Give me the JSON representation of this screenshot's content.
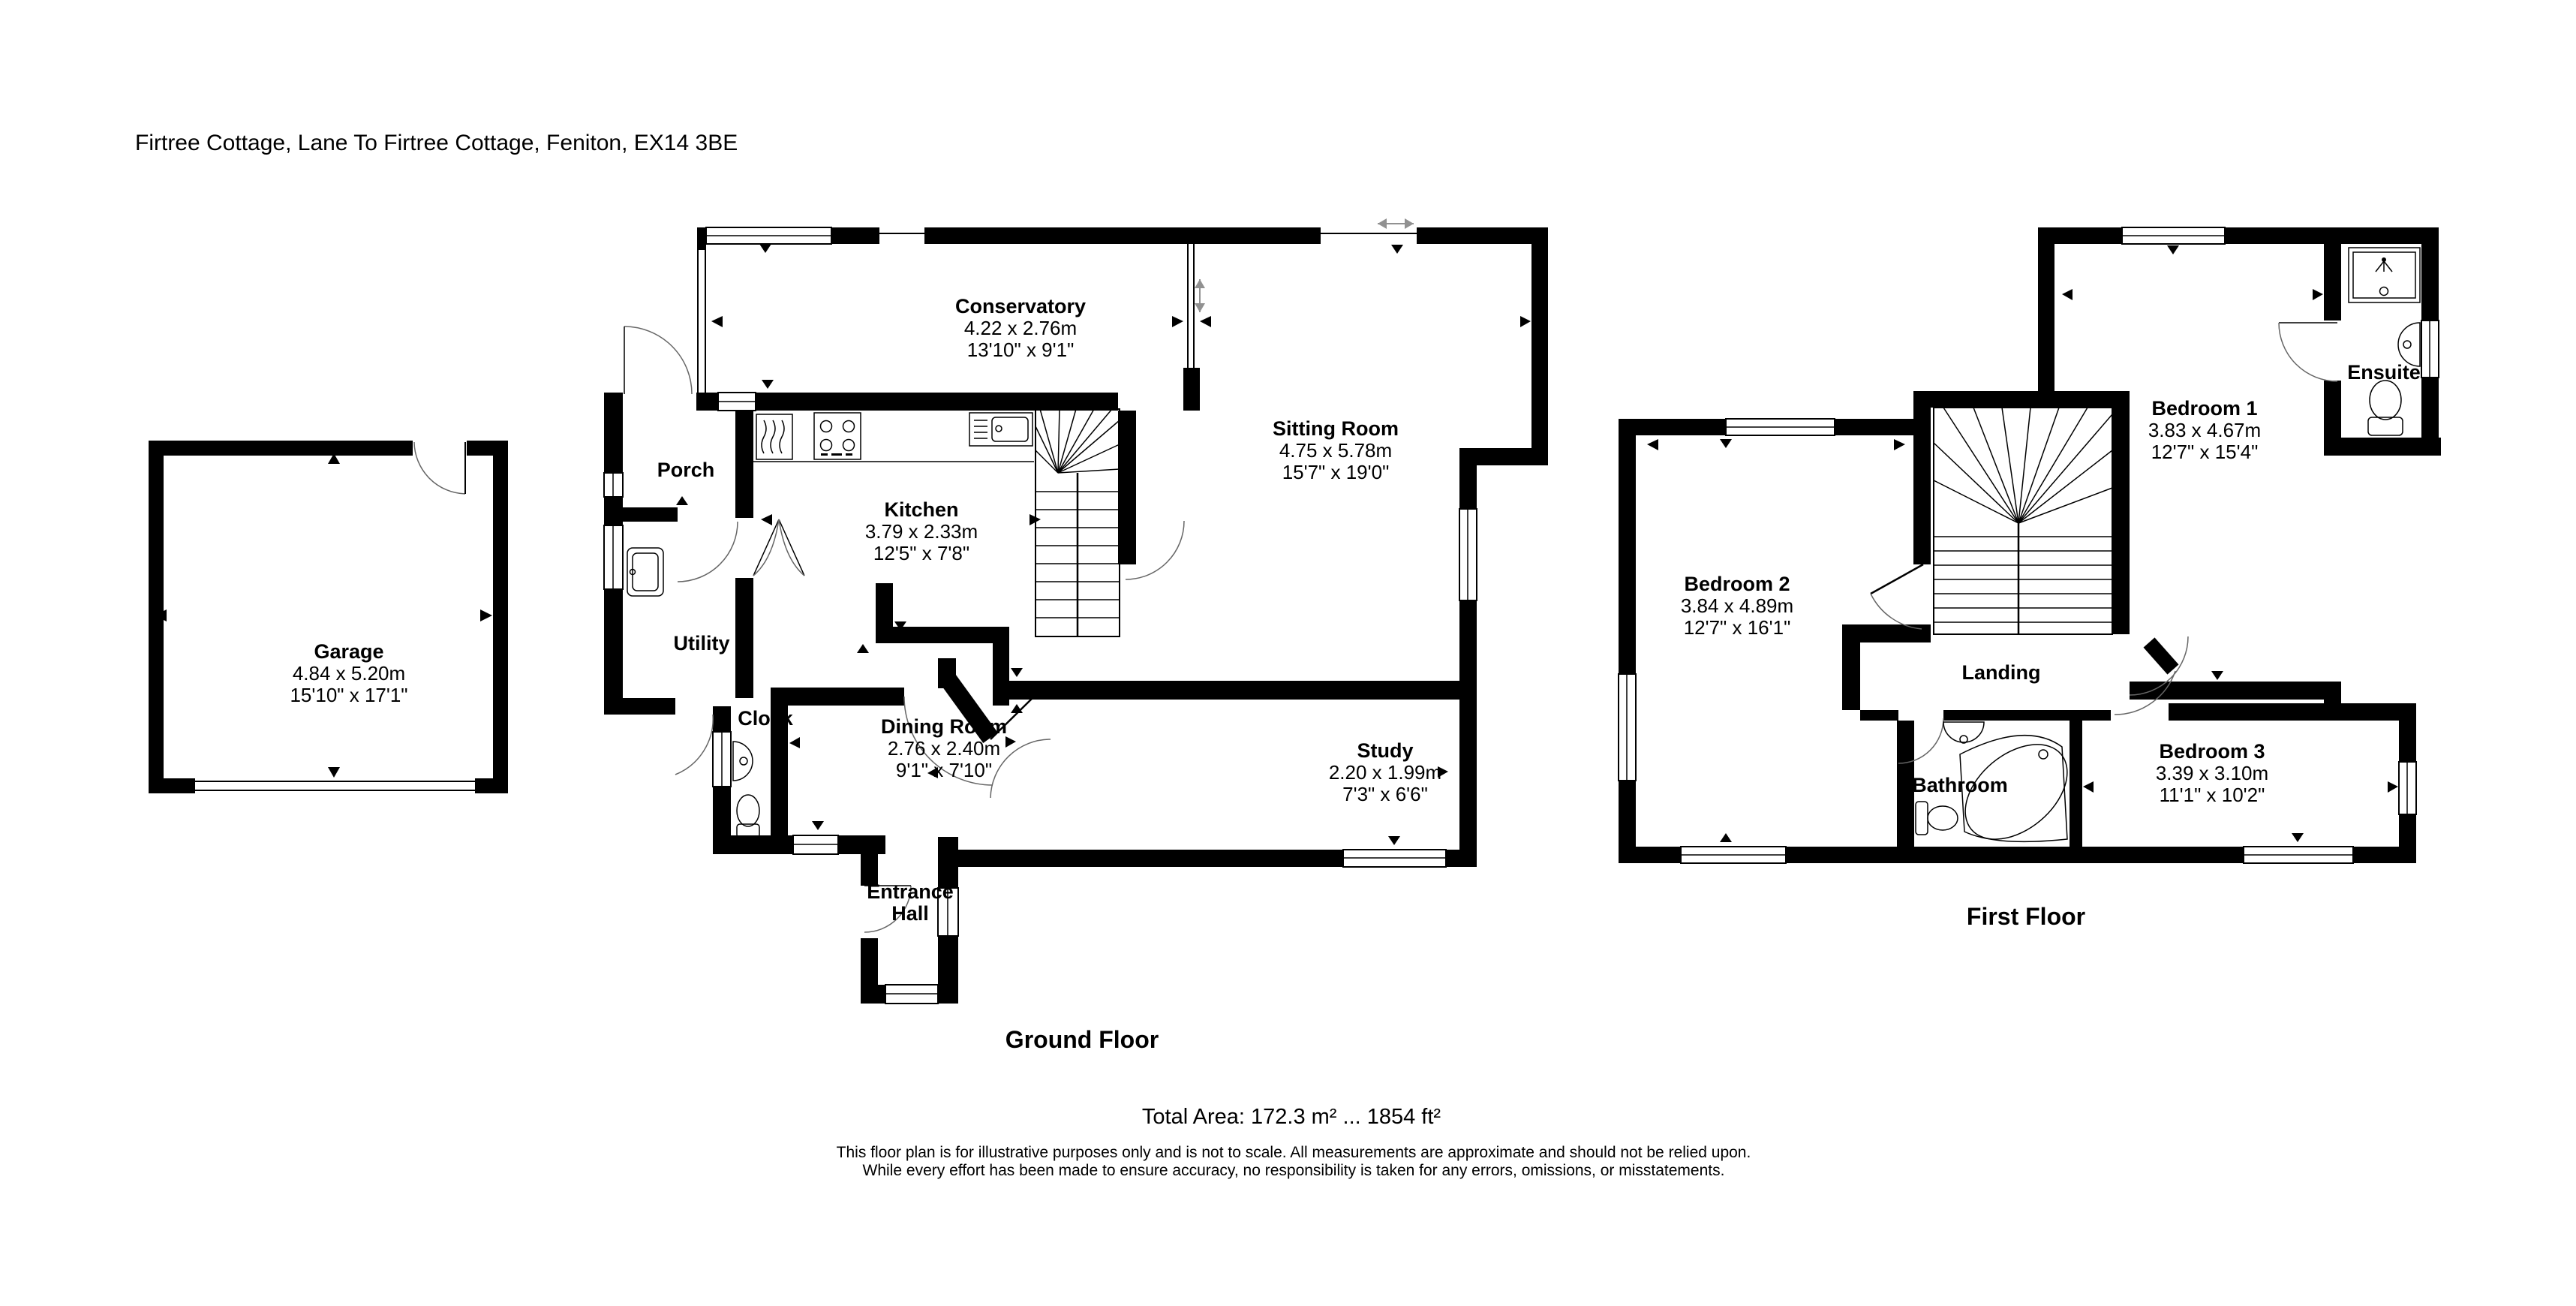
{
  "title": "Firtree Cottage, Lane To Firtree Cottage, Feniton, EX14 3BE",
  "floors": {
    "ground": {
      "label": "Ground Floor",
      "rooms": {
        "garage": {
          "name": "Garage",
          "metric": "4.84 x 5.20m",
          "imperial": "15'10\" x 17'1\""
        },
        "conservatory": {
          "name": "Conservatory",
          "metric": "4.22 x 2.76m",
          "imperial": "13'10\" x 9'1\""
        },
        "sitting": {
          "name": "Sitting Room",
          "metric": "4.75 x 5.78m",
          "imperial": "15'7\" x 19'0\""
        },
        "kitchen": {
          "name": "Kitchen",
          "metric": "3.79 x 2.33m",
          "imperial": "12'5\" x 7'8\""
        },
        "dining": {
          "name": "Dining Room",
          "metric": "2.76 x 2.40m",
          "imperial": "9'1\" x 7'10\""
        },
        "study": {
          "name": "Study",
          "metric": "2.20 x 1.99m",
          "imperial": "7'3\" x 6'6\""
        },
        "porch": {
          "name": "Porch"
        },
        "utility": {
          "name": "Utility"
        },
        "cloak": {
          "name": "Cloak"
        },
        "hall": {
          "name": "Entrance Hall",
          "name_line1": "Entrance",
          "name_line2": "Hall"
        }
      }
    },
    "first": {
      "label": "First Floor",
      "rooms": {
        "bedroom1": {
          "name": "Bedroom 1",
          "metric": "3.83 x 4.67m",
          "imperial": "12'7\" x 15'4\""
        },
        "bedroom2": {
          "name": "Bedroom 2",
          "metric": "3.84 x 4.89m",
          "imperial": "12'7\" x 16'1\""
        },
        "bedroom3": {
          "name": "Bedroom 3",
          "metric": "3.39 x 3.10m",
          "imperial": "11'1\" x 10'2\""
        },
        "landing": {
          "name": "Landing"
        },
        "bathroom": {
          "name": "Bathroom"
        },
        "ensuite": {
          "name": "Ensuite"
        }
      }
    }
  },
  "footer": {
    "total_area": "Total Area: 172.3 m² ... 1854 ft²",
    "disclaimer1": "This floor plan is for illustrative purposes only and is not to scale. All measurements are approximate and should not be relied upon.",
    "disclaimer2": "While every effort has been made to ensure accuracy, no responsibility is taken for any errors, omissions, or misstatements."
  },
  "colors": {
    "wall": "#000000",
    "background": "#ffffff",
    "door_arc": "#666666",
    "dim_arrow": "#919191"
  }
}
